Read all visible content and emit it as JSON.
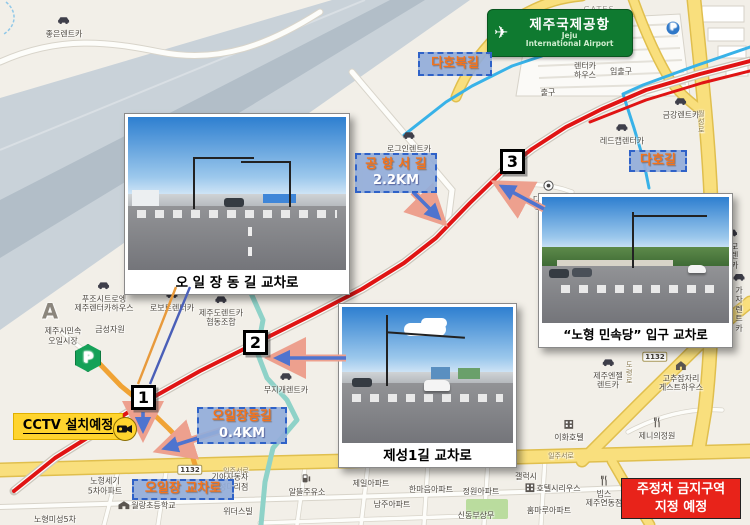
{
  "airport_sign": {
    "title": "제주국제공항",
    "sub1": "Jeju",
    "sub2": "International Airport"
  },
  "cctv": {
    "label": "CCTV 설치예정"
  },
  "notice": {
    "line1": "주정차 금지구역",
    "line2": "지정 예정"
  },
  "photos": [
    {
      "caption": "오 일 장 동 길 교차로"
    },
    {
      "caption": "“노형 민속당”  입구 교차로"
    },
    {
      "caption": "제성1길 교차로"
    }
  ],
  "markers": [
    {
      "n": "1",
      "x": 131,
      "y": 385
    },
    {
      "n": "2",
      "x": 243,
      "y": 330
    },
    {
      "n": "3",
      "x": 500,
      "y": 149
    }
  ],
  "callouts": [
    {
      "lines": [
        "다호북길"
      ],
      "x": 418,
      "y": 52,
      "w": 74,
      "h": 24
    },
    {
      "lines": [
        "다호길"
      ],
      "x": 629,
      "y": 150,
      "w": 58,
      "h": 22
    },
    {
      "lines": [
        "공 항 서 길",
        "2.2KM"
      ],
      "x": 355,
      "y": 153,
      "w": 82,
      "h": 40
    },
    {
      "lines": [
        "오일장동길",
        "0.4KM"
      ],
      "x": 197,
      "y": 407,
      "w": 90,
      "h": 37
    },
    {
      "lines": [
        "오일장 교차로"
      ],
      "x": 132,
      "y": 479,
      "w": 102,
      "h": 21
    }
  ],
  "colors": {
    "route_red": "#e01414",
    "route_cyan": "#38b2e8",
    "road_orange": "#f0a335",
    "river": "#8ed2c8",
    "callout_bg": "#93add9",
    "callout_border": "#2f62c8",
    "callout_text": "#f4731c",
    "notice_bg": "#e8231a",
    "cctv_bg": "#ffd42e",
    "sign_green": "#0f7a30"
  },
  "map": {
    "pois": [
      {
        "label": "좋은렌트카",
        "x": 64,
        "y": 27,
        "icon": "car"
      },
      {
        "label": "GATES",
        "x": 599,
        "y": 10,
        "cls": "gray"
      },
      {
        "label": "렌터카\n하우스",
        "x": 585,
        "y": 64,
        "icon": "car"
      },
      {
        "label": "입출구",
        "x": 621,
        "y": 72
      },
      {
        "label": "출구",
        "x": 548,
        "y": 93
      },
      {
        "label": "P",
        "x": 673,
        "y": 28,
        "icon": "pblue"
      },
      {
        "label": "금강렌트카",
        "x": 681,
        "y": 108,
        "icon": "car"
      },
      {
        "label": "레드캡렌터카",
        "x": 622,
        "y": 134,
        "icon": "car"
      },
      {
        "label": "로그인렌트카",
        "x": 409,
        "y": 142,
        "icon": "car"
      },
      {
        "label": "다호 마을\n복지회관",
        "x": 549,
        "y": 197,
        "icon": "dot"
      },
      {
        "label": "굿모닝렌트카",
        "x": 731,
        "y": 249,
        "icon": "car"
      },
      {
        "label": "가자\n렌트카",
        "x": 739,
        "y": 303,
        "icon": "car"
      },
      {
        "label": "A",
        "x": 50,
        "y": 312,
        "cls": "biggray"
      },
      {
        "label": "푸조시트로엥\n제주렌터카하우스",
        "x": 104,
        "y": 297,
        "icon": "car"
      },
      {
        "label": "로보트렌터카",
        "x": 172,
        "y": 301,
        "icon": "car"
      },
      {
        "label": "제주도렌트카\n협동조합",
        "x": 221,
        "y": 311,
        "icon": "car"
      },
      {
        "label": "제주시민속\n오일시장",
        "x": 63,
        "y": 336
      },
      {
        "label": "금성자원",
        "x": 110,
        "y": 330
      },
      {
        "label": "P",
        "x": 88,
        "y": 358,
        "icon": "pgreen"
      },
      {
        "label": "무지개렌트카",
        "x": 286,
        "y": 383,
        "icon": "car"
      },
      {
        "label": "제주엔젤\n렌트카",
        "x": 608,
        "y": 374,
        "icon": "car"
      },
      {
        "label": "이화호텔",
        "x": 569,
        "y": 431,
        "icon": "hotel"
      },
      {
        "label": "고추잠자리\n게스트하우스",
        "x": 681,
        "y": 377,
        "icon": "house"
      },
      {
        "label": "제니의정원",
        "x": 657,
        "y": 429,
        "icon": "fork"
      },
      {
        "label": "1132",
        "x": 655,
        "y": 357,
        "icon": "badge"
      },
      {
        "label": "1132",
        "x": 190,
        "y": 470,
        "icon": "badge"
      },
      {
        "label": "일주서로",
        "x": 236,
        "y": 471,
        "cls": "road"
      },
      {
        "label": "일주서로",
        "x": 561,
        "y": 456,
        "cls": "road"
      },
      {
        "label": "월성로",
        "x": 701,
        "y": 122,
        "cls": "road vert"
      },
      {
        "label": "도령로",
        "x": 629,
        "y": 373,
        "cls": "road vert"
      },
      {
        "label": "기아자동차\n오성대리점",
        "x": 230,
        "y": 482
      },
      {
        "label": "노형세기\n5차아파트",
        "x": 105,
        "y": 486
      },
      {
        "label": "월랑초등학교",
        "x": 147,
        "y": 506,
        "icon": "school",
        "cls": "row"
      },
      {
        "label": "노형미성5차",
        "x": 55,
        "y": 520
      },
      {
        "label": "보고타렌터카",
        "x": 424,
        "y": 463,
        "icon": "car",
        "cls": "row"
      },
      {
        "label": "알뜰주유소",
        "x": 307,
        "y": 485,
        "icon": "gas"
      },
      {
        "label": "제일아파트",
        "x": 371,
        "y": 484
      },
      {
        "label": "한마음아파트",
        "x": 431,
        "y": 490
      },
      {
        "label": "정원아파트",
        "x": 481,
        "y": 492
      },
      {
        "label": "남주아파트",
        "x": 392,
        "y": 505
      },
      {
        "label": "신동부상무",
        "x": 476,
        "y": 516
      },
      {
        "label": "갤럭시",
        "x": 526,
        "y": 477
      },
      {
        "label": "호텔시리우스",
        "x": 553,
        "y": 489,
        "icon": "hotel",
        "cls": "row"
      },
      {
        "label": "빕스\n제주연동점",
        "x": 604,
        "y": 492,
        "icon": "fork"
      },
      {
        "label": "홈마루아파트",
        "x": 549,
        "y": 511
      },
      {
        "label": "위더스빌",
        "x": 238,
        "y": 512
      }
    ],
    "routes": [
      {
        "name": "river",
        "color": "#8ed2c8",
        "width": 5,
        "points": [
          [
            250,
            291
          ],
          [
            263,
            320
          ],
          [
            257,
            352
          ],
          [
            267,
            378
          ],
          [
            287,
            400
          ],
          [
            297,
            420
          ],
          [
            273,
            448
          ],
          [
            265,
            482
          ],
          [
            261,
            525
          ]
        ]
      },
      {
        "name": "orange-road-oiljangdong-gil",
        "color": "#f0a335",
        "width": 5,
        "points": [
          [
            96,
            360
          ],
          [
            121,
            386
          ],
          [
            143,
            404
          ],
          [
            169,
            429
          ],
          [
            191,
            452
          ],
          [
            197,
            471
          ]
        ]
      },
      {
        "name": "cyan-route-dahobuk-gil",
        "color": "#38b2e8",
        "width": 3,
        "points": [
          [
            404,
            135
          ],
          [
            446,
            102
          ],
          [
            472,
            86
          ],
          [
            512,
            66
          ],
          [
            542,
            56
          ]
        ]
      },
      {
        "name": "cyan-route-daho-gil",
        "color": "#38b2e8",
        "width": 3,
        "points": [
          [
            750,
            47
          ],
          [
            692,
            67
          ],
          [
            643,
            85
          ],
          [
            623,
            94
          ],
          [
            634,
            128
          ],
          [
            643,
            158
          ],
          [
            649,
            188
          ]
        ]
      },
      {
        "name": "red-route-parallel",
        "color": "#e01414",
        "width": 3,
        "points": [
          [
            590,
            122
          ],
          [
            646,
            100
          ],
          [
            702,
            83
          ],
          [
            750,
            71
          ]
        ]
      },
      {
        "name": "red-route-main",
        "color": "#e01414",
        "width": 4,
        "road_underlay": true,
        "points": [
          [
            14,
            491
          ],
          [
            55,
            458
          ],
          [
            100,
            430
          ],
          [
            143,
            403
          ],
          [
            200,
            371
          ],
          [
            252,
            345
          ],
          [
            312,
            315
          ],
          [
            362,
            289
          ],
          [
            404,
            263
          ],
          [
            436,
            238
          ],
          [
            470,
            203
          ],
          [
            502,
            172
          ],
          [
            532,
            149
          ],
          [
            566,
            127
          ],
          [
            602,
            109
          ],
          [
            646,
            90
          ],
          [
            700,
            74
          ],
          [
            750,
            61
          ]
        ]
      }
    ],
    "arrows": [
      {
        "x1": 413,
        "y1": 192,
        "x2": 438,
        "y2": 217
      },
      {
        "x1": 544,
        "y1": 209,
        "x2": 503,
        "y2": 187
      },
      {
        "x1": 346,
        "y1": 358,
        "x2": 278,
        "y2": 358
      },
      {
        "x1": 223,
        "y1": 430,
        "x2": 166,
        "y2": 448
      },
      {
        "x1": 143,
        "y1": 412,
        "x2": 143,
        "y2": 429
      }
    ],
    "leaders": [
      {
        "x1": 190,
        "y1": 287,
        "x2": 150,
        "y2": 384,
        "color": "#4a5fb8"
      },
      {
        "x1": 176,
        "y1": 287,
        "x2": 138,
        "y2": 384,
        "color": "#e89a3c"
      }
    ]
  }
}
